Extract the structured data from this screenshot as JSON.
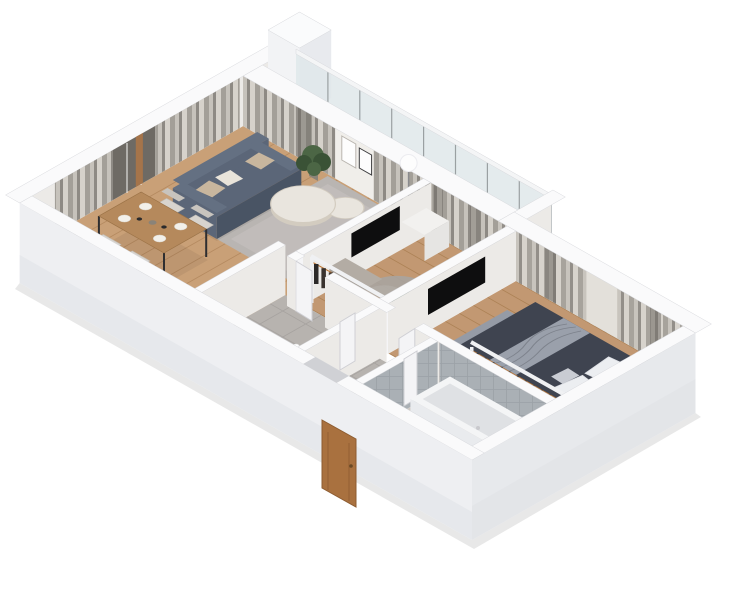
{
  "scene": {
    "type": "isometric-3d-apartment-floor-plan-render",
    "view": "axonometric-from-south",
    "rooms": [
      {
        "name": "kitchen-dining",
        "floor": "wood",
        "furniture": [
          "kitchen-counter-black-marble",
          "sink",
          "cooktop",
          "cutting-board",
          "dining-table",
          "four-dining-chairs",
          "window-curtains",
          "wood-window-post"
        ]
      },
      {
        "name": "living-room",
        "floor": "wood",
        "furniture": [
          "sofa",
          "throw-pillows",
          "nesting-coffee-tables",
          "area-rug",
          "floor-lamp",
          "potted-plant",
          "wall-art-frames",
          "curtained-glass-doors"
        ]
      },
      {
        "name": "balcony",
        "floor": "tile",
        "furniture": [
          "glass-railing",
          "concrete-shaft-block"
        ]
      },
      {
        "name": "small-room",
        "floor": "wood",
        "furniture": [
          "open-wardrobe-with-clothes",
          "sideboard",
          "tv-panel",
          "round-rug",
          "potted-plant",
          "white-cabinet",
          "interior-door"
        ]
      },
      {
        "name": "bedroom",
        "floor": "wood",
        "furniture": [
          "double-bed-dark",
          "white-pillows",
          "throw-blanket",
          "foot-bench",
          "open-wardrobe-with-clothes",
          "wall-tv",
          "window-curtains",
          "interior-door"
        ]
      },
      {
        "name": "bathroom",
        "walls": "gray-tile",
        "floor": "marble",
        "furniture": [
          "bathtub",
          "toilet",
          "pedestal-sink",
          "interior-door"
        ]
      },
      {
        "name": "hallway-entrance",
        "floor": "tile",
        "furniture": [
          "entry-door-brown",
          "black-shoe-rack",
          "slippers",
          "black-door-mat",
          "divider-wall"
        ]
      }
    ]
  },
  "palette": {
    "background": "#ffffff",
    "wallInner": "#eceae7",
    "wallInnerLight": "#f0eeea",
    "wallTop": "#fafafb",
    "wallEdge": "#d7d8dc",
    "wallOuter": "#eeeff2",
    "wallOuter2": "#e7e9ec",
    "wallShade": "#e4e6ea",
    "wallShade2": "#e1e3e7",
    "wallEnd": "#f5f5f7",
    "chimney1": "#f2f3f5",
    "chimney2": "#e8eaee",
    "chimneyTop": "#fafbfc",
    "floorWood": "#c9a077",
    "floorWoodLine": "#b58a60",
    "floorWood2": "#c29872",
    "floorWood2Line": "#ad8256",
    "tile": "#b7b3af",
    "grout": "#a7a3a0",
    "marble": "#cfc9c3",
    "marbleVein": "#bdb6b0",
    "balcFloor": "#d8d8da",
    "balcLine": "#c9c9cc",
    "rug": "#b9b5b2",
    "rugLight": "#c6c2bf",
    "rugRound": "#a8a4a0",
    "rugRoundHi": "#b7b3ae",
    "curtain0": "#d6d2cb",
    "curtain1": "#c6c2bb",
    "curtain2": "#a39f98",
    "curtain3": "#8e8a84",
    "sheer": "#e3e0da",
    "windowDark": "#6e6a64",
    "mullion": "#f5f5f5",
    "glass": "#dfe8ea",
    "glassFrame": "#9aa0a2",
    "railWhite": "#f4f5f6",
    "sofa": "#5b6678",
    "sofaDark": "#495464",
    "sofaSeat": "#647082",
    "cushionBeige": "#c8b69e",
    "cushionWhite": "#e9e4da",
    "tableTop": "#e9e5de",
    "tableSide": "#d3ccc0",
    "dinWood": "#b5895c",
    "dinWoodEdge": "#9c7347",
    "legDark": "#2e2e30",
    "chairFabric": "#d8d4ce",
    "chairBack": "#c8c4be",
    "counterBlack": "#1b1c1e",
    "counterDark": "#242527",
    "counterStreak": "#3a3b3e",
    "applianceBlack": "#0b0b0d",
    "applianceRing": "#4a4b4e",
    "board": "#b5804e",
    "bed": "#3f4450",
    "bedDark": "#343946",
    "bedThrow": "#9aa0ab",
    "throwLine": "#7d828c",
    "pillow": "#eceef1",
    "pillowEdge": "#dfe1e6",
    "headboard": "#2f3440",
    "benchTop": "#959ba6",
    "benchSide": "#868c98",
    "clothesA": "#2c2a29",
    "clothesB": "#4a4039",
    "clothesC": "#39322e",
    "copper": "#b87333",
    "rackWhite": "#f0f1f3",
    "tv": "#0e0e0f",
    "doorBrown": "#a9713f",
    "doorBrownDark": "#8d5c31",
    "doorKnob": "#6b4a26",
    "doorWhite": "#f4f4f6",
    "doorEdge": "#cfcfd4",
    "threshold": "#d0d1d5",
    "plant": "#4c6645",
    "plantDark": "#3a5236",
    "pot": "#8a8378",
    "bathTile": "#aab0b5",
    "bathTileLine": "#9ba1a6",
    "tub": "#f4f5f6",
    "tubShade": "#dfe1e4",
    "tubFace": "#e9ebee",
    "tubEnd": "#eff1f4",
    "porcelain": "#ffffff",
    "porcelainEdge": "#d5d7db",
    "faucet": "#c9c9cd",
    "lamp": "#fdfdfd",
    "lampPole": "#8a8a8e",
    "artFrame": "#3c3c3e",
    "artMat": "#fdfdfd",
    "artEdge": "#b9b5af",
    "woodPost": "#a5744a",
    "sideboardTop": "#b3aca4",
    "sideboardFace": "#a59e96",
    "cabinetTop": "#f2f1ef",
    "cabinetFace": "#e6e5e3",
    "rackBlack": "#1c1d1f",
    "rackBlackFace": "#26272a",
    "shoeA": "#c9c1b4",
    "shoeB": "#8a6f52",
    "matBlack": "#141416"
  }
}
